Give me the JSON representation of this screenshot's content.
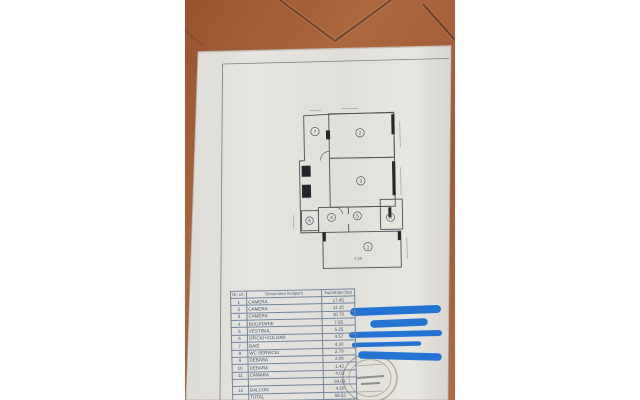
{
  "photo": {
    "description": "photo of a photocopied apartment floor-plan sheet lying on terracotta tiles",
    "tile_color": "#a2603c",
    "grout_color": "#6f3e26",
    "paper_color": "#e3e1dc",
    "marker_color": "#1d6fd2"
  },
  "plan": {
    "rooms": {
      "r1": "1",
      "r2": "2",
      "r3": "3",
      "r4": "4",
      "r5": "5",
      "r6": "6",
      "r7": "7",
      "r8": "8"
    },
    "dim_label": "4.50"
  },
  "table": {
    "headers": {
      "nr": "Nr. crt.",
      "name": "Denumirea încăperii",
      "area": "Suprafața (mp)"
    },
    "rows": [
      {
        "nr": "1",
        "name": "CAMERA",
        "area": "17.45"
      },
      {
        "nr": "2",
        "name": "CAMERA",
        "area": "11.15"
      },
      {
        "nr": "3",
        "name": "CAMERA",
        "area": "10.70"
      },
      {
        "nr": "4",
        "name": "BUCATARIE",
        "area": "7.55"
      },
      {
        "nr": "5",
        "name": "VESTIBUL",
        "area": "5.25"
      },
      {
        "nr": "6",
        "name": "OFICIU+CULOAR",
        "area": "4.57"
      },
      {
        "nr": "7",
        "name": "BAIE",
        "area": "4.30"
      },
      {
        "nr": "8",
        "name": "WC SERVICIU",
        "area": "2.70"
      },
      {
        "nr": "9",
        "name": "DEBARA",
        "area": "2.06"
      },
      {
        "nr": "10",
        "name": "DEBARA",
        "area": "1.42"
      },
      {
        "nr": "11",
        "name": "CAMARA",
        "area": "4.03"
      },
      {
        "nr": "",
        "name": "",
        "area": "54.03"
      },
      {
        "nr": "12",
        "name": "BALCON",
        "area": "4.50"
      },
      {
        "nr": "",
        "name": "TOTAL",
        "area": "58.53"
      }
    ]
  },
  "redactions": {
    "color": "#1d6fd2",
    "count": 5
  },
  "stamp": {
    "present": true,
    "shape": "round",
    "legible": false
  }
}
